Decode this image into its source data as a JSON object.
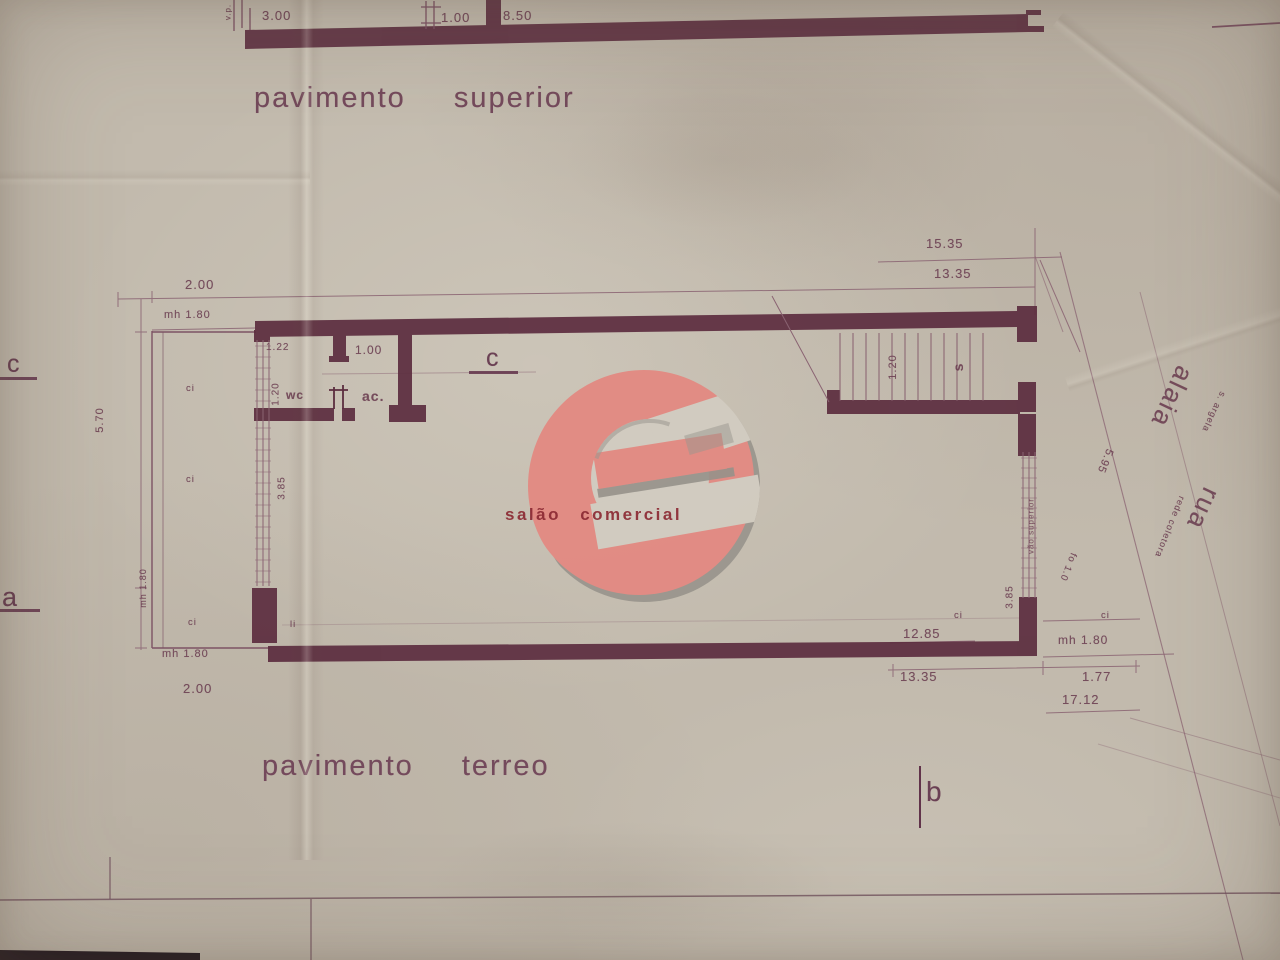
{
  "palette": {
    "paper": "#c2baad",
    "ink": "#5c2d3f",
    "ink_light": "#7d5364",
    "accent": "#e5857e",
    "label_red": "#8c2a33"
  },
  "upper_plan": {
    "title": "pavimento superior",
    "dim_left": "3.00",
    "dim_door": "1.00",
    "dim_span": "8.50",
    "vp": "v.p."
  },
  "ground_plan": {
    "title": "pavimento terreo",
    "hall": "salão comercial",
    "dims": {
      "total_top": "15.35",
      "inner_top": "13.35",
      "corr_top": "2.00",
      "corr_mh_top": "mh 1.80",
      "corr_height": "5.70",
      "corr_mh_mid": "mh 1.80",
      "corr_mh_bottom": "mh 1.80",
      "corr_bottom": "2.00",
      "wc_w": "1.22",
      "wc_d": "1.20",
      "door": "1.00",
      "win_left": "3.85",
      "stair_w": "1.20",
      "diag": "5.95",
      "fo": "fo 1.0",
      "win_right": "3.85",
      "inner_bottom": "12.85",
      "mh_bottom": "mh 1.80",
      "inner_bottom2": "13.35",
      "side": "1.77",
      "total_bottom": "17.12"
    },
    "rooms": {
      "wc": "wc",
      "ac": "ac.",
      "stair": "s",
      "window_note": "vão superior"
    },
    "closet": "ci",
    "closet2": "li",
    "sections": {
      "c": "c",
      "a": "a",
      "b": "b"
    }
  },
  "street": {
    "name": "alaia",
    "rua": "rua",
    "note1": "s. argela",
    "note2": "rede coletora"
  }
}
